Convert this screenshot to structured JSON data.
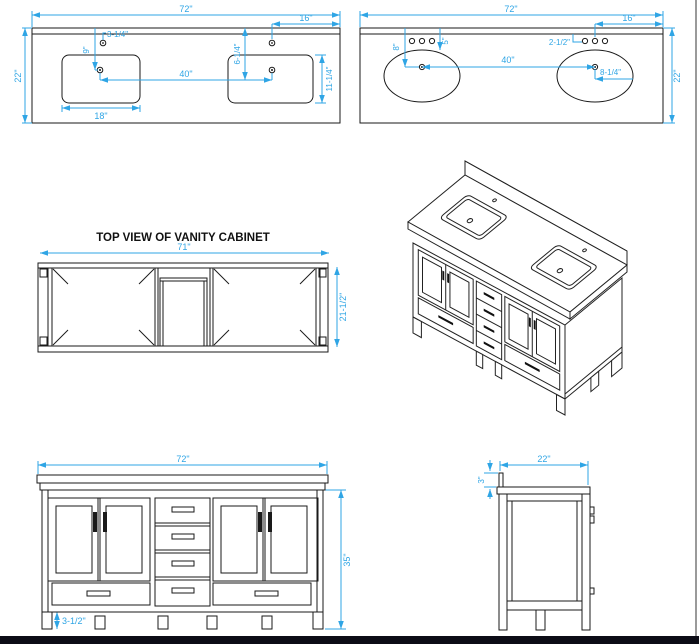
{
  "colors": {
    "dimension_lines": "#2FA5E5",
    "drawing_lines": "#1a1a1a",
    "background": "#ffffff",
    "frame_bottom": "#0c0c16",
    "frame_right": "#9a9a9a"
  },
  "drawings": {
    "countertop_rect_sinks": {
      "dims": {
        "overall_width": "72\"",
        "faucet_from_right": "16\"",
        "faucet_offset": "3-1/4\"",
        "back_to_drain": "9\"",
        "back_to_faucet": "6-1/4\"",
        "drain_spacing": "40\"",
        "sink_depth": "11-1/4\"",
        "sink_width": "18\"",
        "overall_depth": "22\""
      }
    },
    "countertop_oval_sinks": {
      "dims": {
        "overall_width": "72\"",
        "faucet_from_right": "16\"",
        "hole_spacing": "2-1/2\"",
        "back_to_drain": "8\"",
        "back_to_faucet": "5\"",
        "drain_spacing": "40\"",
        "drain_to_edge": "8-1/4\"",
        "overall_depth": "22\""
      }
    },
    "cabinet_top_view": {
      "title": "TOP VIEW OF VANITY CABINET",
      "dims": {
        "width": "71\"",
        "depth": "21-1/2\""
      }
    },
    "cabinet_front_view": {
      "dims": {
        "width": "72\"",
        "height": "35\"",
        "toe_kick": "3-1/2\""
      }
    },
    "cabinet_side_view": {
      "dims": {
        "depth": "22\"",
        "backsplash_height": "3\""
      }
    }
  }
}
